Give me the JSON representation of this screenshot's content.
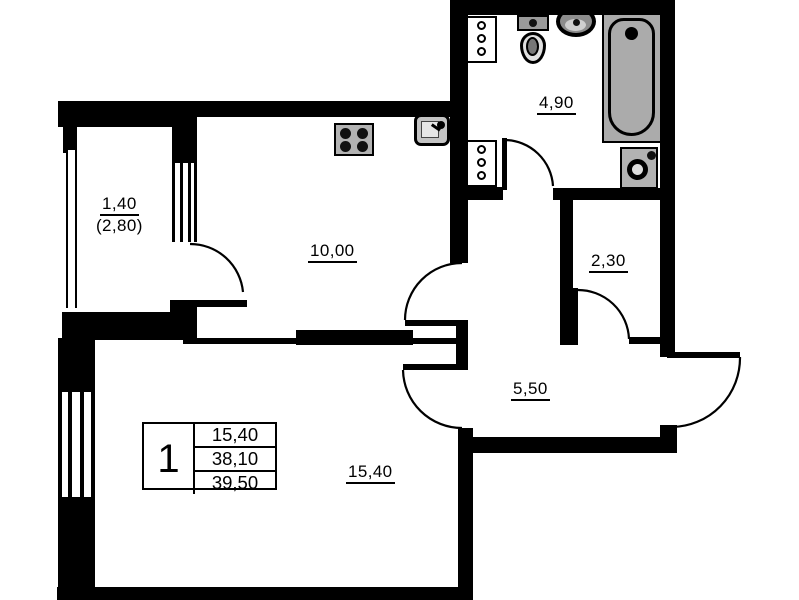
{
  "document": {
    "kind": "apartment floor plan"
  },
  "rooms": {
    "balcony": {
      "label": "1,40",
      "label_secondary": "(2,80)"
    },
    "kitchen": {
      "label": "10,00"
    },
    "bathroom": {
      "label": "4,90"
    },
    "storage": {
      "label": "2,30"
    },
    "hallway": {
      "label": "5,50"
    },
    "living_room": {
      "label": "15,40"
    }
  },
  "stamp": {
    "rooms_count": "1",
    "living_area": "15,40",
    "apartment_area": "38,10",
    "total_area": "39,50"
  },
  "fixtures": {
    "kitchen": [
      "stove-icon",
      "kitchen-sink-icon",
      "riser-shaft-icon"
    ],
    "bathroom": [
      "toilet-icon",
      "washbasin-icon",
      "bathtub-icon",
      "washing-machine-icon",
      "riser-shaft-icon"
    ]
  },
  "colors": {
    "wall": "#000000",
    "background": "#ffffff",
    "fixture_fill": "#ababab"
  }
}
